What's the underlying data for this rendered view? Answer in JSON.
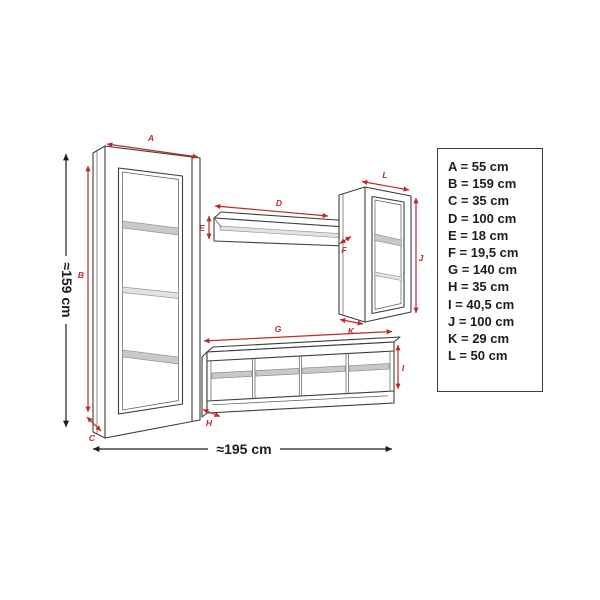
{
  "diagram": {
    "overall_height_label": "≈159 cm",
    "overall_width_label": "≈195 cm",
    "arrow_labels": {
      "A": "A",
      "B": "B",
      "C": "C",
      "D": "D",
      "E": "E",
      "F": "F",
      "G": "G",
      "H": "H",
      "I": "I",
      "J": "J",
      "K": "K",
      "L": "L"
    }
  },
  "legend": {
    "items": [
      "A = 55 cm",
      "B = 159 cm",
      "C = 35 cm",
      "D = 100 cm",
      "E = 18 cm",
      "F = 19,5 cm",
      "G = 140 cm",
      "H = 35 cm",
      "I = 40,5 cm",
      "J = 100 cm",
      "K = 29 cm",
      "L = 50 cm"
    ]
  },
  "colors": {
    "dimension_red": "#c1272d",
    "outline_gray": "#3d3d3c",
    "shelf_gray": "#c9c9c9",
    "text_black": "#1d1d1b",
    "background": "#ffffff"
  }
}
